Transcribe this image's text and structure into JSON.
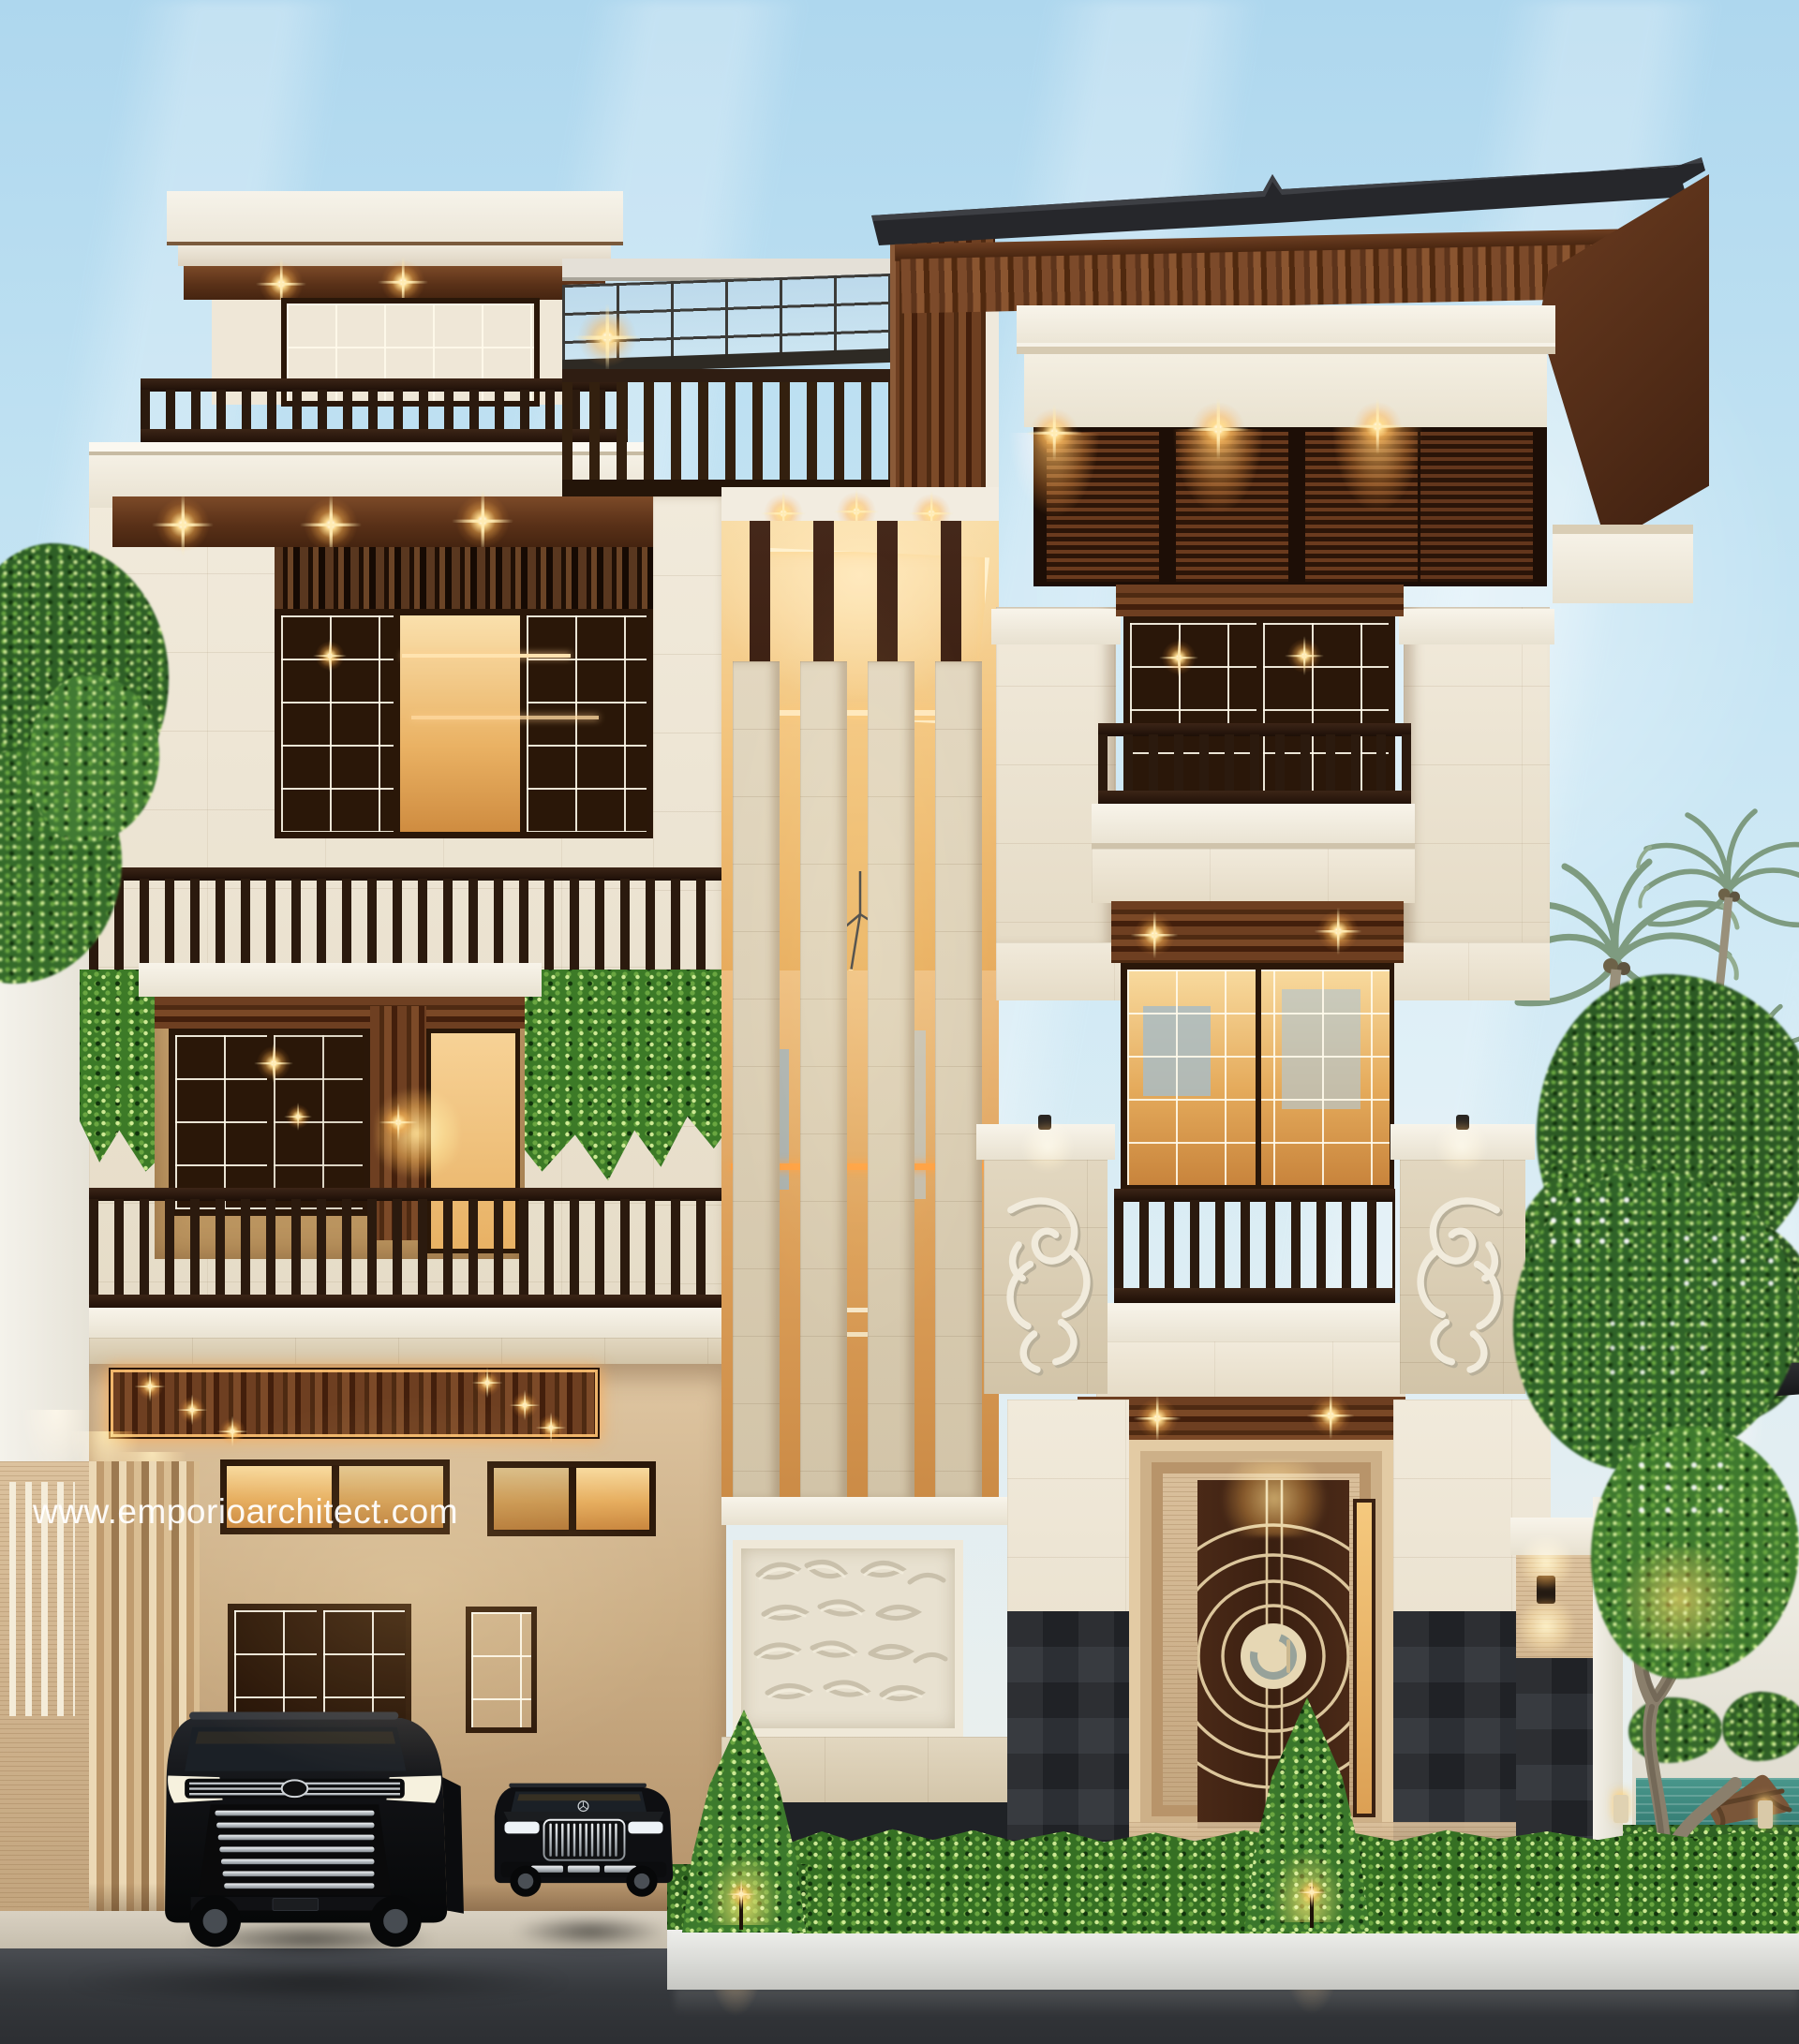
{
  "watermark": {
    "text": "www.emporioarchitect.com"
  },
  "scene": {
    "description": "Photorealistic dusk render of a modern tropical four-storey villa: cream stone facade, dark timber accents, Balinese carved stone pillars, warm glowing interiors, rooftop glass pergola, carport with two black luxury cars, clipped hedge planter, frangipani and coconut palms under a pale blue streaked sky."
  },
  "palette": {
    "sky": "#bfe0f2",
    "cream_wall": "#efe7d6",
    "white_trim": "#f6f2e9",
    "travertine": "#cdb08c",
    "wood_dark": "#3a2315",
    "wood_mid": "#6e4226",
    "roof": "#26272b",
    "window_glow": "#f0bd74",
    "railing": "#2c1b11",
    "hedge": "#3f7c2d",
    "vine": "#4c8a33",
    "palm": "#87a389",
    "pool": "#3f8d84",
    "asphalt": "#3c3f43",
    "stone_dark": "#2f3237",
    "carved_stone": "#e6dfcf",
    "door_brown": "#47291a",
    "door_inlay": "#dfcba2"
  }
}
